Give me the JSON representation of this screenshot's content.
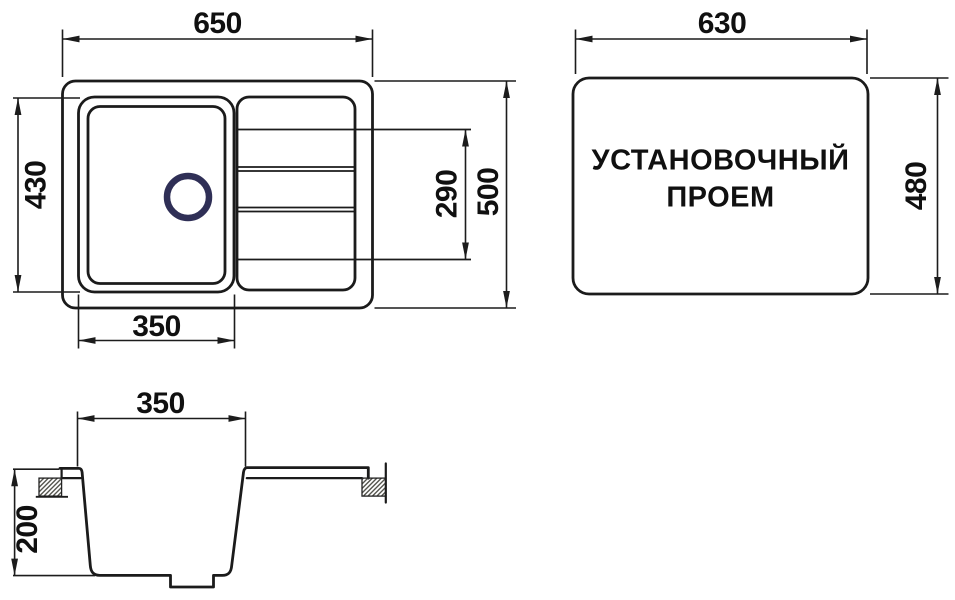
{
  "top_view": {
    "overall_width": "650",
    "overall_depth": "500",
    "bowl_depth": "430",
    "bowl_width": "350",
    "drainboard_length": "290"
  },
  "cutout_view": {
    "label_line1": "УСТАНОВОЧНЫЙ",
    "label_line2": "ПРОЕМ",
    "width": "630",
    "height": "480"
  },
  "section_view": {
    "bowl_top_width": "350",
    "bowl_depth": "200"
  },
  "colors": {
    "line": "#1b1b1b",
    "dimension_text": "#101010",
    "drain_ring": "#2f2f56",
    "background": "#ffffff"
  }
}
